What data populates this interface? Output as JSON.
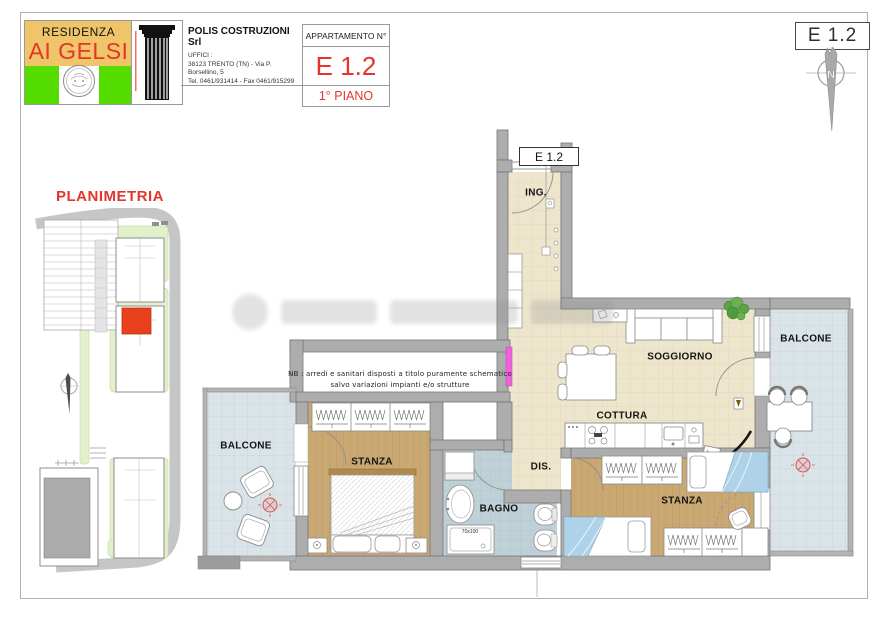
{
  "sheet": {
    "unit_ref": "E 1.2"
  },
  "header": {
    "logo": {
      "top": "RESIDENZA",
      "name": "AI GELSI"
    },
    "company": {
      "name": "POLIS COSTRUZIONI Srl",
      "office": "UFFICI :",
      "address": "38123 TRENTO (TN) - Via P. Borsellino, 5",
      "phones": "Tel. 0461/931414 - Fax 0461/915299"
    },
    "apartment": {
      "label": "APPARTAMENTO N°",
      "number": "E 1.2",
      "floor": "1° PIANO"
    }
  },
  "compass": {
    "north": "N"
  },
  "site_plan": {
    "title": "PLANIMETRIA"
  },
  "plan": {
    "unit_tag": "E 1.2",
    "note1": "NB : arredi e sanitari disposti a titolo puramente schematico",
    "note2": "salvo variazioni impianti e/o strutture",
    "rooms": {
      "ing": "ING.",
      "soggiorno": "SOGGIORNO",
      "cottura": "COTTURA",
      "dis": "DIS.",
      "bagno": "BAGNO",
      "stanza_left": "STANZA",
      "stanza_right": "STANZA",
      "balcone_left": "BALCONE",
      "balcone_right": "BALCONE",
      "shower": "70x100"
    }
  },
  "colors": {
    "accent_red": "#E5342B",
    "logo_green": "#55DD00",
    "logo_tan": "#F0C468",
    "highlight_red": "#E8401C",
    "wall_gray": "#ADADAD",
    "floor_beige": "#EDE5CC",
    "floor_wood": "#C9A873",
    "floor_bath": "#BFD1D7",
    "floor_balcony": "#D9E2E6",
    "radiator_magenta": "#EE63DC"
  }
}
